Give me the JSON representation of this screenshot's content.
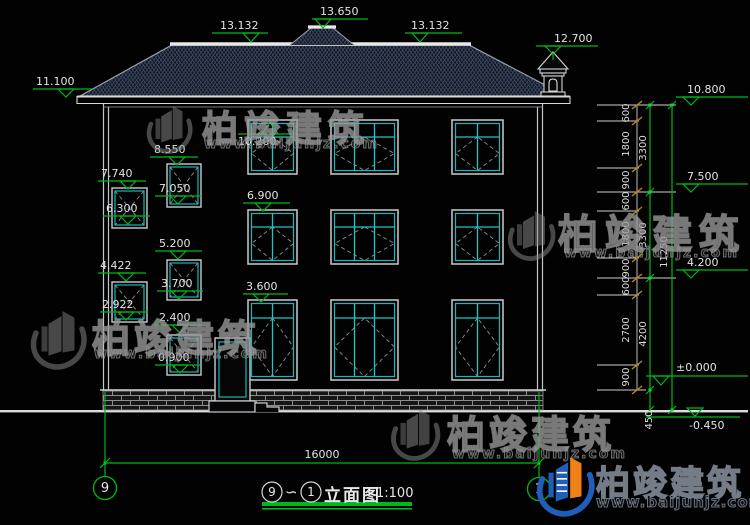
{
  "drawing": {
    "title": {
      "left_bubble": "9",
      "separator": "∽",
      "right_bubble": "1",
      "name": "立面图",
      "scale": "1:100"
    },
    "grid_axes": {
      "left": "9",
      "right": "1"
    },
    "overall_width_dim": "16000",
    "elevation_markers": {
      "eave_left": "11.100",
      "ridge_left": "13.132",
      "ridge_center": "13.650",
      "ridge_right": "13.132",
      "cupola": "12.700",
      "right_eave": "10.800",
      "right_floor3": "7.500",
      "right_floor2": "4.200",
      "right_zero": "±0.000",
      "right_ground": "-0.450",
      "win3f_top": "10.200",
      "stair_b1_top": "8.550",
      "stair_a1_top": "7.740",
      "stair_b1_bottom": "7.050",
      "stair_a1_bottom": "6.300",
      "win2f_top": "6.900",
      "stair_b2_top": "5.200",
      "stair_a2_top": "4.422",
      "stair_b2_bottom": "3.700",
      "stair_a2_bottom": "2.922",
      "win1f_top": "3.600",
      "door_top": "2.400",
      "stair_b3_bottom": "0.900"
    },
    "dim_chain_inner": [
      "600",
      "1800",
      "900",
      "600",
      "1800",
      "900",
      "600",
      "2700",
      "900"
    ],
    "dim_chain_floors": [
      "3300",
      "3300",
      "4200"
    ],
    "dim_total": "11250",
    "dim_below_ground": "450"
  },
  "watermark": {
    "brand": "柏竣建筑",
    "url": "www.baijunjz.com"
  }
}
